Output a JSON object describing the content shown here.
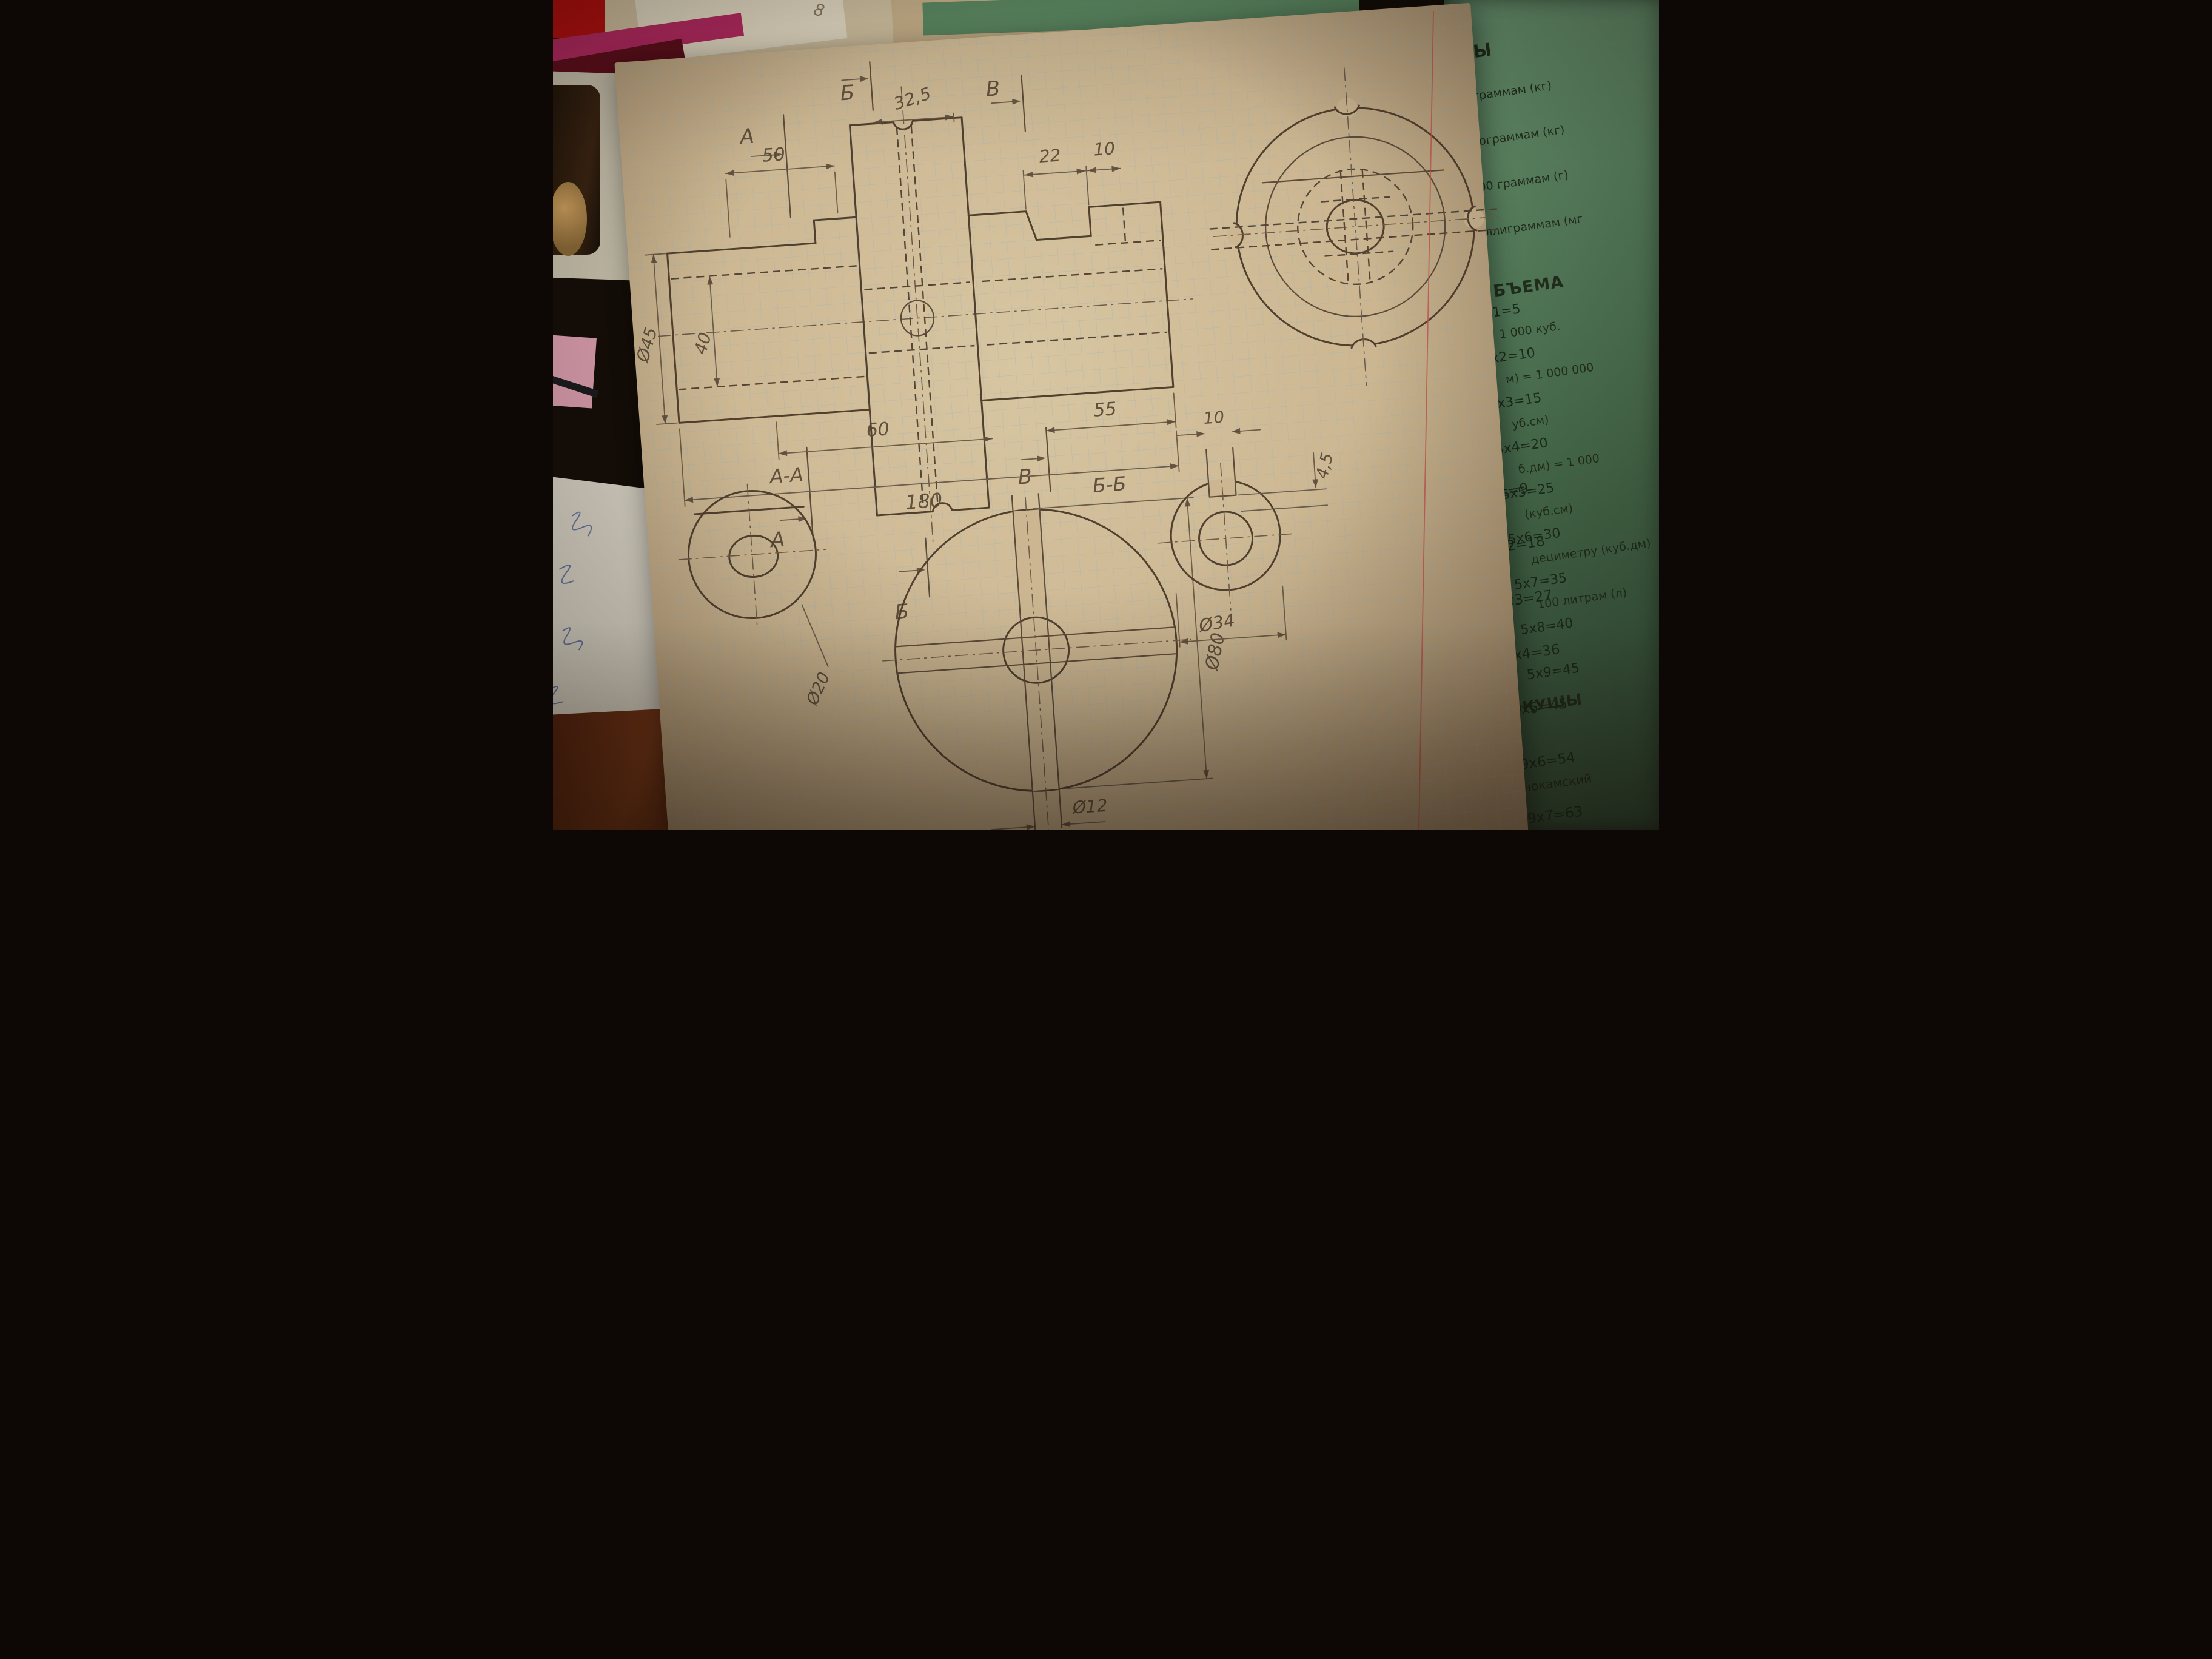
{
  "scene": {
    "stray_mark": "8"
  },
  "drawing": {
    "sections": {
      "a": "А",
      "b": "Б",
      "v": "В"
    },
    "front_view_dims": {
      "len50": "50",
      "len32_5": "32,5",
      "len22": "22",
      "len10": "10",
      "dia45": "Ø45",
      "dia40": "40",
      "len60": "60",
      "len55": "55",
      "len180": "180"
    },
    "view_aa": {
      "title": "А-А",
      "bore": "Ø20"
    },
    "view_bb": {
      "title": "Б-Б",
      "outer": "Ø80",
      "hole": "Ø12",
      "holes_count": "4 отв."
    },
    "view_vv": {
      "key_width": "10",
      "key_depth": "4,5",
      "outer": "Ø34"
    }
  },
  "green_page": {
    "weights_heading": "СЫ",
    "weights_lines": [
      "ограммам (кг)",
      "тограммам (кг)",
      "00 граммам (г)",
      "ллиграммам (мг"
    ],
    "volume_heading": "БЪЕМА",
    "volume_lines": [
      "1 000 куб.",
      "м) = 1 000 000",
      "уб.см)",
      "б.дм) = 1 000",
      "(куб.см)",
      "дециметру (куб.дм)",
      "100 литрам (л)"
    ],
    "table5": [
      "5x1=5",
      "5x2=10",
      "5x3=15",
      "5x4=20",
      "5x5=25",
      "5x6=30",
      "5x7=35",
      "5x8=40",
      "5x9=45"
    ],
    "table9": [
      "9x1=9",
      "9x2=18",
      "9x3=27",
      "9x4=36",
      "9x5=45",
      "9x6=54",
      "9x7=63",
      "9x8=72",
      "9x9=81"
    ],
    "brand_badge": "KZ",
    "brand_title": "ОҚУШЫ",
    "contact_lines": [
      "«Краснокамский",
      "полиграфическ",
      "комбинат» АБК",
      "Ресей, 61706",
      "Краснокамск к",
      "Тел.: (34273)",
      "E-mail: kam"
    ],
    "edge_fragments": [
      "5",
      "к"
    ]
  }
}
